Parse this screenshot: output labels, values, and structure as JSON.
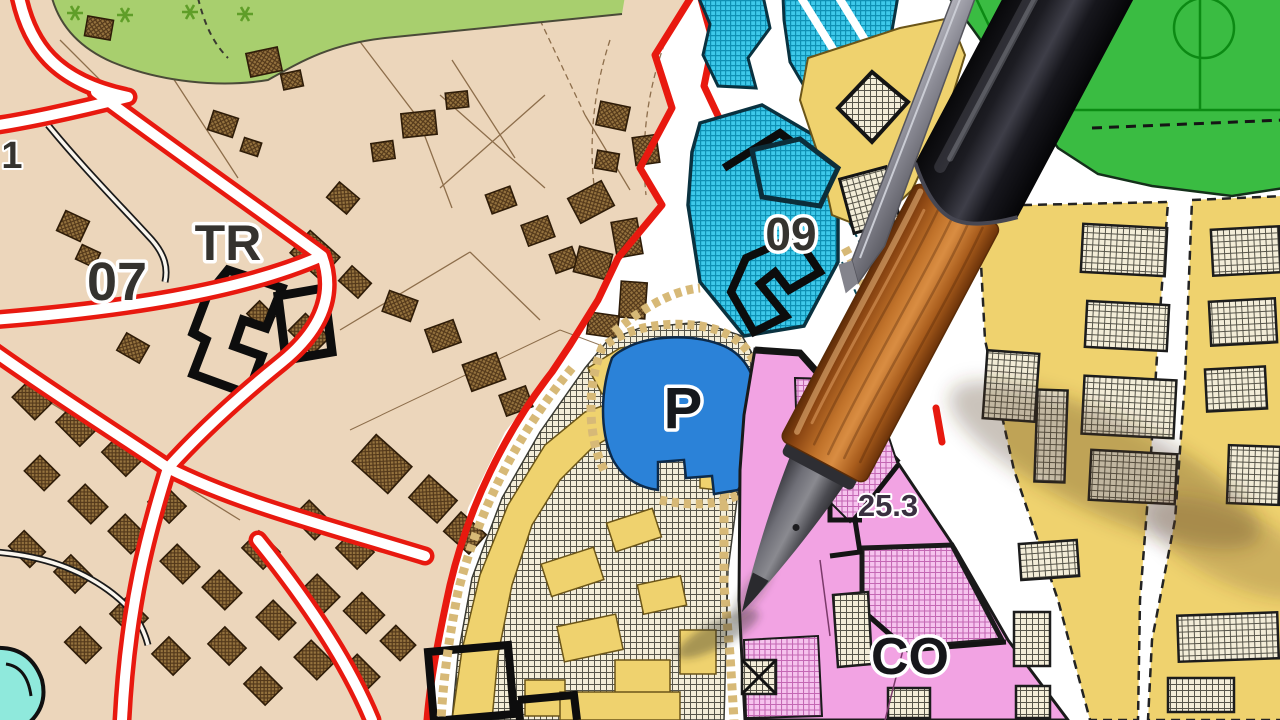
{
  "map": {
    "type": "urban-zoning-plan",
    "labels": {
      "district_left": "07",
      "district_left_tag": "TR",
      "parcel_number": "1",
      "district_cyan": "09",
      "parking": "P",
      "area_value": "25.3",
      "district_pink": "CO"
    },
    "colors": {
      "parcel_beige": "#ecd6bb",
      "building_brown": "#96743f",
      "road_red": "#e8190f",
      "zone_cyan": "#3ec9ea",
      "parking_blue": "#2b82d8",
      "zone_yellow": "#efd26e",
      "building_cream": "#f3edd8",
      "zone_pink": "#f2a3e3",
      "green_area": "#a8cf6e",
      "sports_green": "#3abc42",
      "edge_tan": "#d7b977",
      "outline_black": "#111111",
      "pond_turquoise": "#8fe9dc"
    },
    "objects": {
      "pen": "wooden-ballpoint-pen"
    }
  }
}
